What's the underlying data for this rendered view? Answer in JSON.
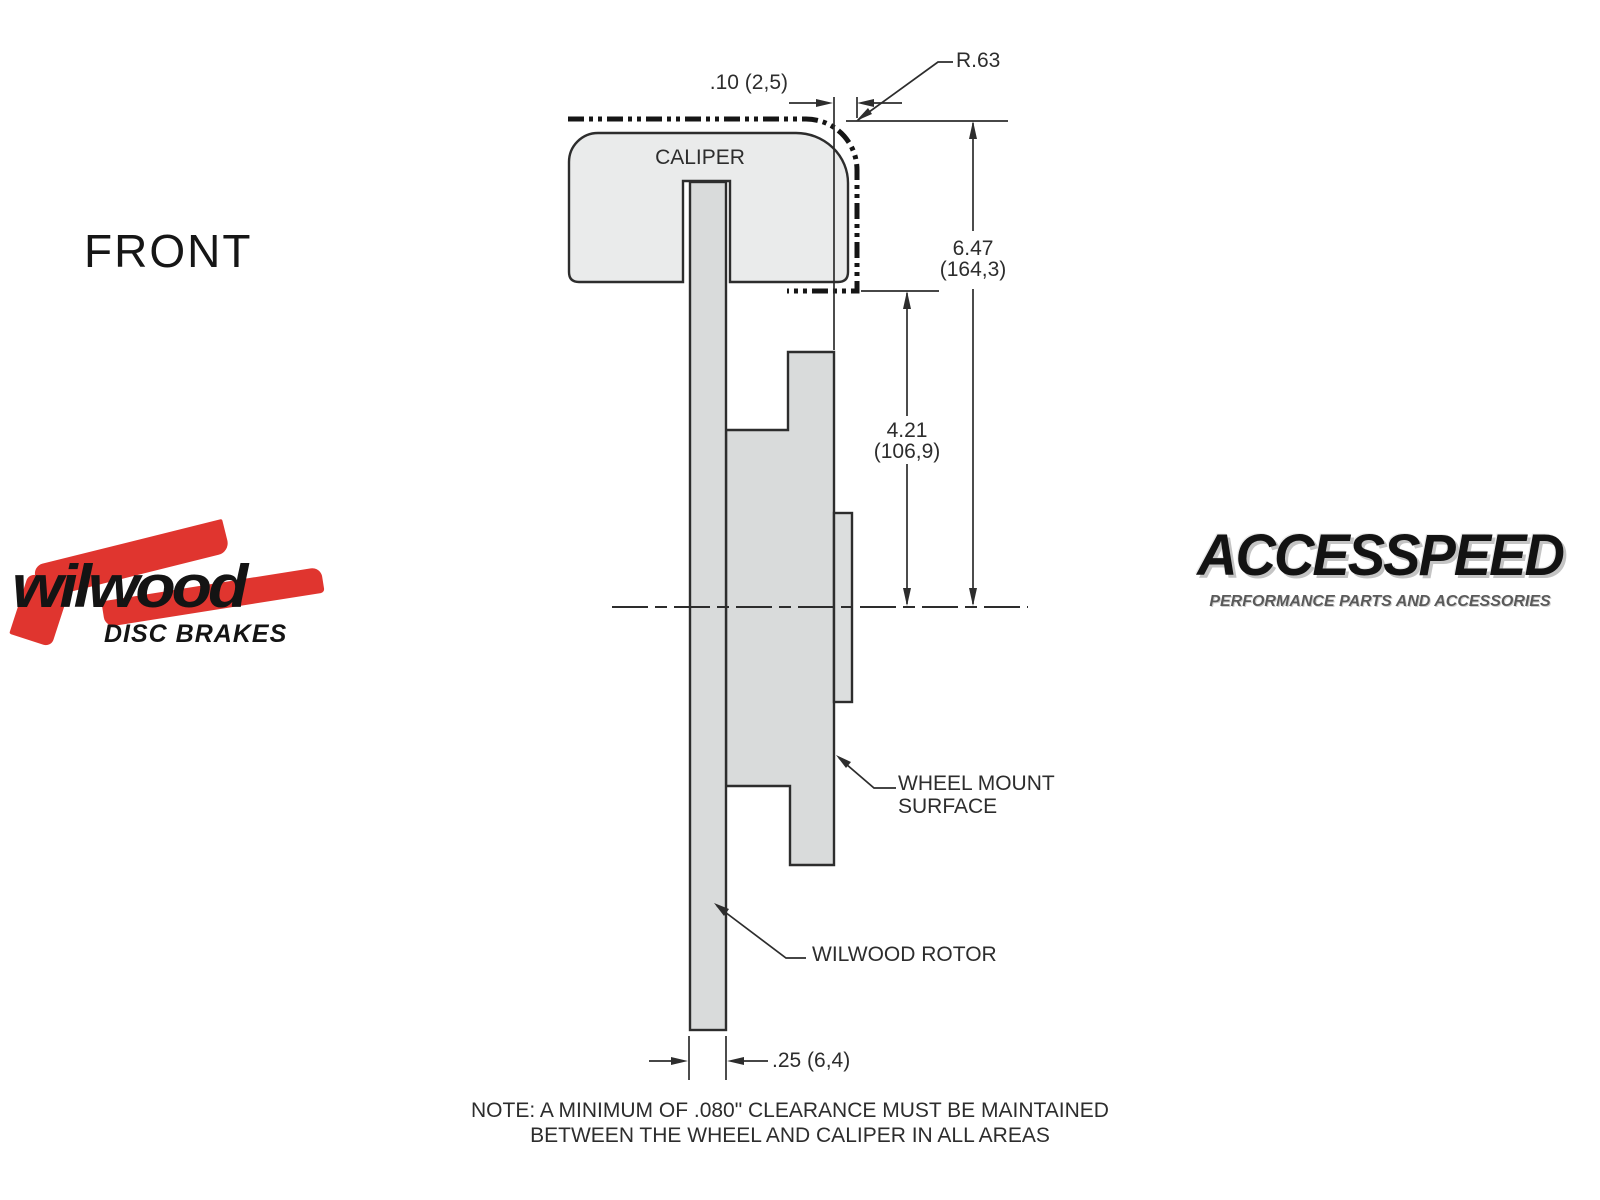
{
  "colors": {
    "page_bg": "#ffffff",
    "line": "#2d2d2d",
    "caliper_fill": "#eaebeb",
    "rotor_fill": "#d9dbdb",
    "stud_fill": "#dcdede",
    "wilwood_red": "#e0352f",
    "tagline_gray": "#5a5a5a"
  },
  "view_label": "FRONT",
  "diagram": {
    "caliper_label": "CALIPER",
    "dimensions": {
      "radius": "R.63",
      "clearance_top": ".10 (2,5)",
      "overall_height_in": "6.47",
      "overall_height_mm": "(164,3)",
      "mount_height_in": "4.21",
      "mount_height_mm": "(106,9)",
      "rotor_thickness": ".25 (6,4)"
    },
    "callouts": {
      "wheel_mount_line1": "WHEEL MOUNT",
      "wheel_mount_line2": "SURFACE",
      "rotor": "WILWOOD ROTOR"
    },
    "note_line1": "NOTE: A MINIMUM OF .080\" CLEARANCE MUST BE MAINTAINED",
    "note_line2": "BETWEEN THE WHEEL AND CALIPER IN ALL AREAS"
  },
  "logos": {
    "wilwood": {
      "name": "wilwood",
      "subtitle": "DISC BRAKES"
    },
    "accesspeed": {
      "name": "ACCESSPEED",
      "tagline": "PERFORMANCE PARTS AND ACCESSORIES"
    }
  }
}
